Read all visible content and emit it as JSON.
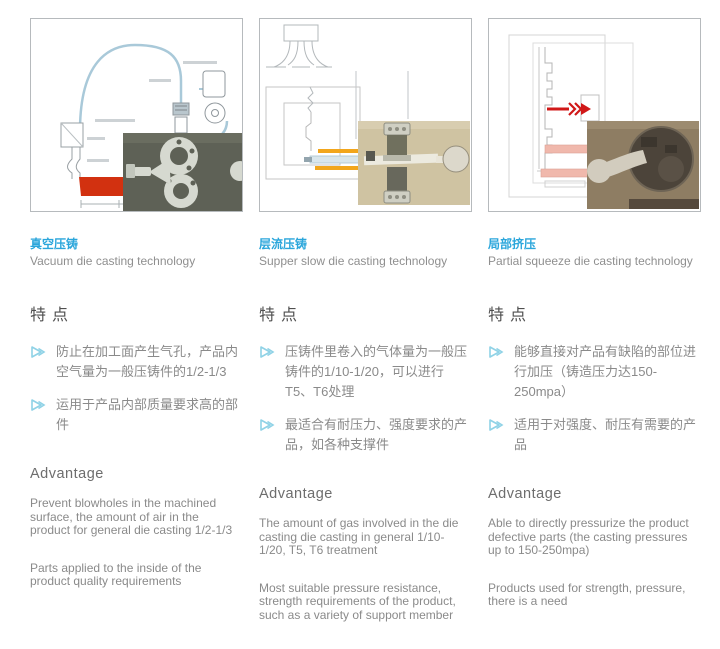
{
  "accent_color": "#2ba6db",
  "bullet_color": "#8fd2e6",
  "heading_color": "#4f4f4f",
  "body_text_color": "#8a8a8a",
  "columns": [
    {
      "title_cn": "真空压铸",
      "title_en": "Vacuum die casting technology",
      "features_heading": "特点",
      "features": [
        "防止在加工面产生气孔，产品内空气量为一般压铸件的1/2-1/3",
        "运用于产品内部质量要求高的部件"
      ],
      "advantage_heading": "Advantage",
      "advantages": [
        "Prevent blowholes in the machined surface, the amount of air in the product for general die casting 1/2-1/3",
        "Parts applied to the inside of the product quality requirements"
      ],
      "diagram": "vacuum-die-casting-schematic"
    },
    {
      "title_cn": "层流压铸",
      "title_en": "Supper slow die casting technology",
      "features_heading": "特点",
      "features": [
        "压铸件里卷入的气体量为一般压铸件的1/10-1/20，可以进行T5、T6处理",
        "最适合有耐压力、强度要求的产品，如各种支撑件"
      ],
      "advantage_heading": "Advantage",
      "advantages": [
        "The amount of gas involved in the die casting die casting in general 1/10-1/20, T5, T6 treatment",
        "Most suitable pressure resistance, strength requirements of the product, such as a variety of support member"
      ],
      "diagram": "super-slow-die-casting-schematic"
    },
    {
      "title_cn": "局部挤压",
      "title_en": "Partial squeeze die casting technology",
      "features_heading": "特点",
      "features": [
        "能够直接对产品有缺陷的部位进行加压（铸造压力达150-250mpa）",
        "适用于对强度、耐压有需要的产品"
      ],
      "advantage_heading": "Advantage",
      "advantages": [
        "Able to directly pressurize the product defective parts (the casting pressures up to 150-250mpa)",
        "Products used for strength, pressure, there is a need"
      ],
      "diagram": "partial-squeeze-schematic"
    }
  ]
}
